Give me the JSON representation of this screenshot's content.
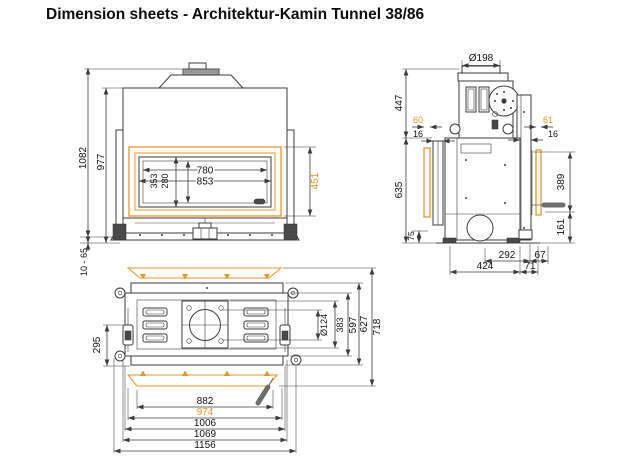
{
  "title": "Dimension sheets - Architektur-Kamin Tunnel 38/86",
  "colors": {
    "accent": "#ea9428",
    "line": "#3b3b3b"
  },
  "front_view": {
    "dims": {
      "total_height": "1082",
      "body_height": "977",
      "feet_range": "10 - 65",
      "glass_width": "780",
      "door_width": "853",
      "door_height": "353",
      "glass_height": "280",
      "frame_height": "451"
    }
  },
  "side_view": {
    "dims": {
      "flue_diameter": "Ø198",
      "upper_height": "447",
      "frame_depth_left": "60",
      "gap_left": "16",
      "body_height": "635",
      "base_height": "75",
      "frame_depth_right": "61",
      "gap_right": "16",
      "handle_height": "389",
      "lower_height": "161",
      "inner_depth": "292",
      "rear_depth": "67",
      "body_depth": "424",
      "front_depth": "71"
    }
  },
  "plan_view": {
    "dims": {
      "latch_offset": "295",
      "flue_diameter": "Ø124",
      "opening_depth": "383",
      "inner_depth": "597",
      "body_depth": "627",
      "total_depth": "718",
      "inner_width": "882",
      "frame_width": "974",
      "body_width": "1006",
      "outer_width": "1069",
      "total_width": "1156"
    }
  }
}
